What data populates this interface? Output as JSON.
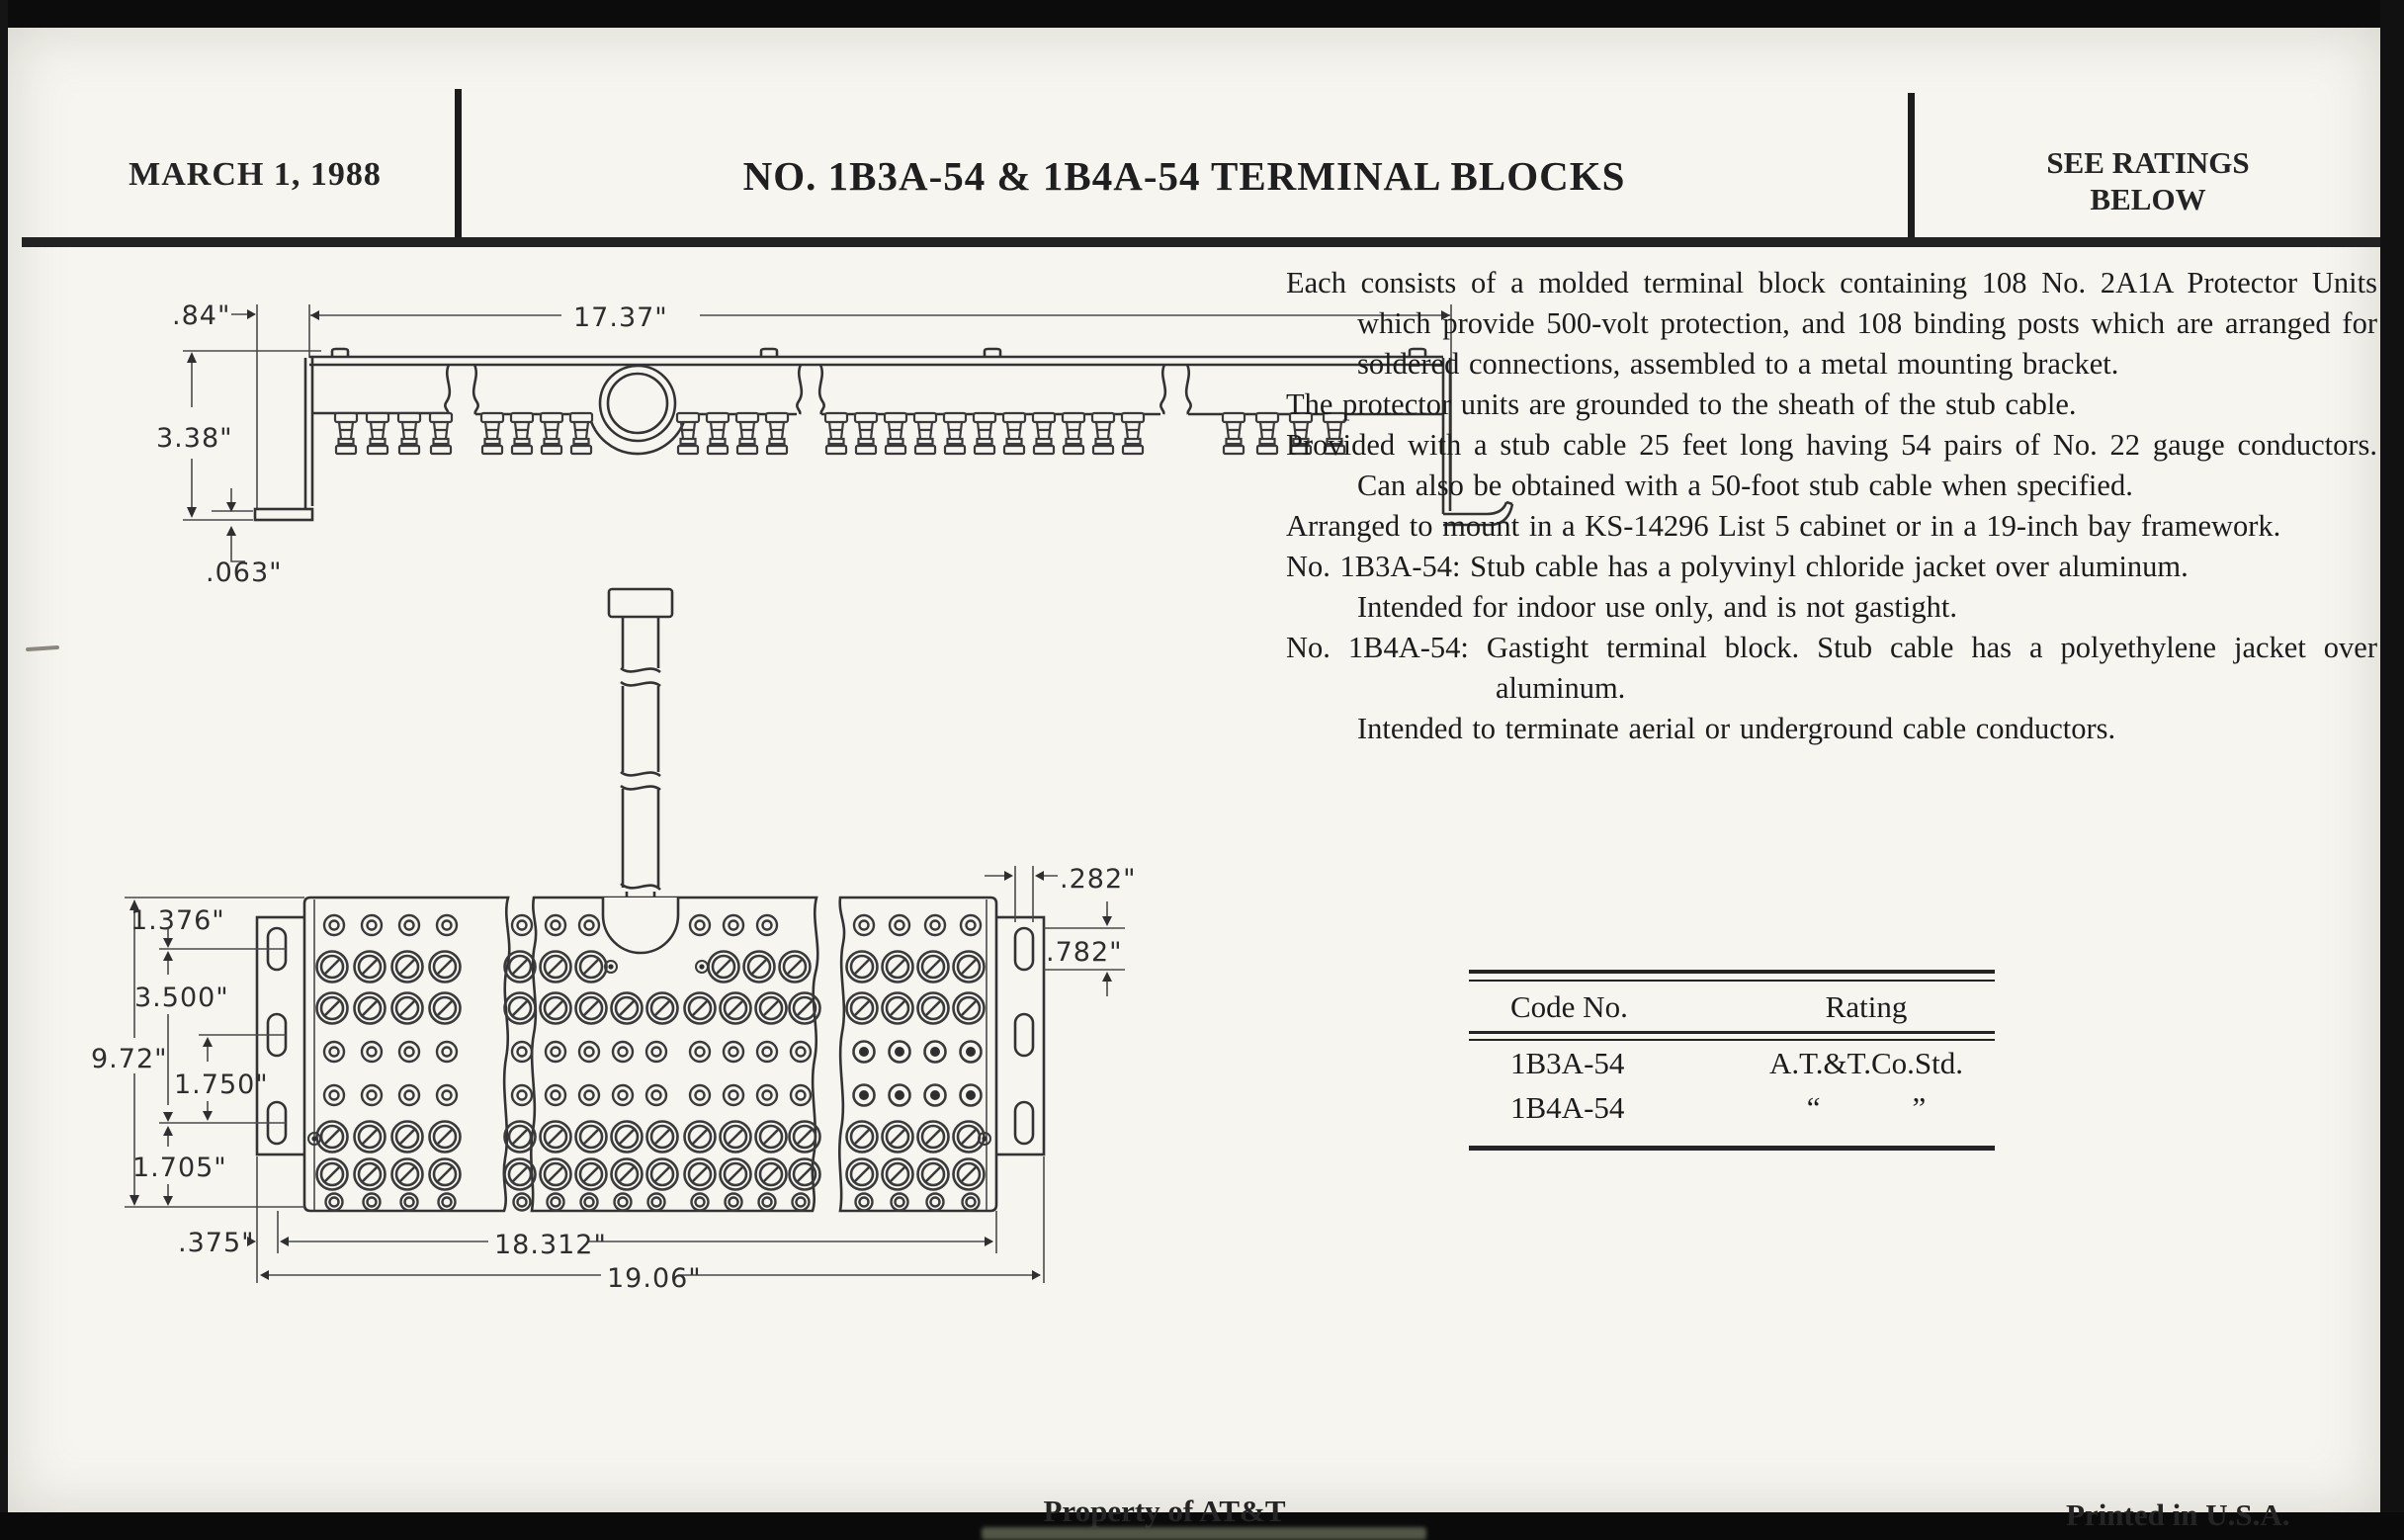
{
  "header": {
    "date": "MARCH 1, 1988",
    "title": "NO. 1B3A-54 & 1B4A-54 TERMINAL BLOCKS",
    "ratings_line1": "SEE RATINGS",
    "ratings_line2": "BELOW"
  },
  "description": {
    "paragraphs": [
      "Each consists of a molded terminal block containing 108 No. 2A1A Protector Units which provide 500-volt protection, and 108 binding posts which are arranged for soldered connections, assembled to a metal mounting bracket.",
      "The protector units are grounded to the sheath of the stub cable.",
      "Provided with a stub cable 25 feet long having 54 pairs of No. 22 gauge conductors. Can also be obtained with a 50-foot stub cable when specified.",
      "Arranged to mount in a KS-14296 List 5 cabinet or in a 19-inch bay framework.",
      "No. 1B3A-54: Stub cable has a polyvinyl chloride jacket over aluminum.",
      "Intended for indoor use only, and is not gastight.",
      "No. 1B4A-54: Gastight terminal block. Stub cable has a polyethylene jacket over aluminum.",
      "Intended to terminate aerial or underground cable conductors."
    ]
  },
  "ratings_table": {
    "col1": "Code No.",
    "col2": "Rating",
    "rows": [
      {
        "code": "1B3A-54",
        "rating": "A.T.&T.Co.Std."
      },
      {
        "code": "1B4A-54",
        "rating": "“   ”"
      }
    ]
  },
  "footer": {
    "left": "Property of AT&T",
    "right": "Printed in U.S.A."
  },
  "drawings": {
    "side_view": {
      "dims": {
        "bracket_offset": ".84\"",
        "overall_width": "17.37\"",
        "height": "3.38\"",
        "foot_thickness": ".063\""
      }
    },
    "plan_view": {
      "dims": {
        "top_to_slot1": "1.376\"",
        "slot1_to_slot3": "3.500\"",
        "overall_height": "9.72\"",
        "slot2_to_slot3": "1.750\"",
        "slot3_to_bottom": "1.705\"",
        "bracket_inset": ".375\"",
        "block_width": "18.312\"",
        "overall_width": "19.06\"",
        "slot_width": ".282\"",
        "slot_height": ".782\""
      }
    }
  },
  "colors": {
    "paper": "#f6f5f0",
    "ink": "#242424",
    "line": "#3a3a3a"
  }
}
